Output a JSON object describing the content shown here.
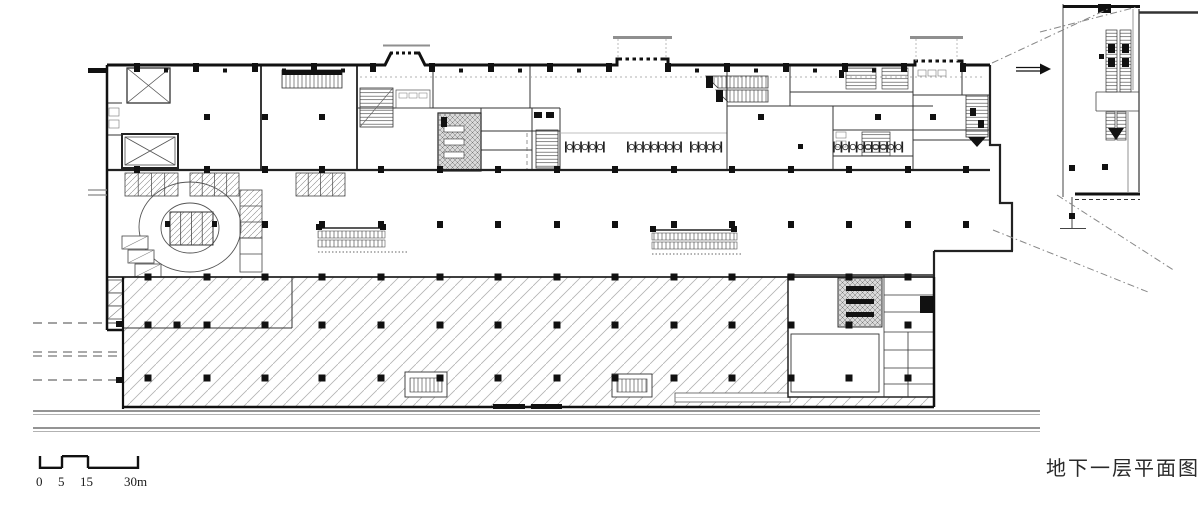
{
  "title_label": {
    "text": "地下一层平面图"
  },
  "scale_bar": {
    "labels": [
      "0",
      "5",
      "15",
      "30m"
    ]
  },
  "colors": {
    "background": "#ffffff",
    "wall_ink": "#111111",
    "medium_line": "#444444",
    "garage_hatch_line": "#b3b3b3",
    "stall_hatch_line": "#8a8a8a",
    "core_gray_fill": "#d9d9d9",
    "canopy_gray": "#8f8f8f",
    "road_line": "#555555",
    "dashed_projection": "#888888"
  }
}
